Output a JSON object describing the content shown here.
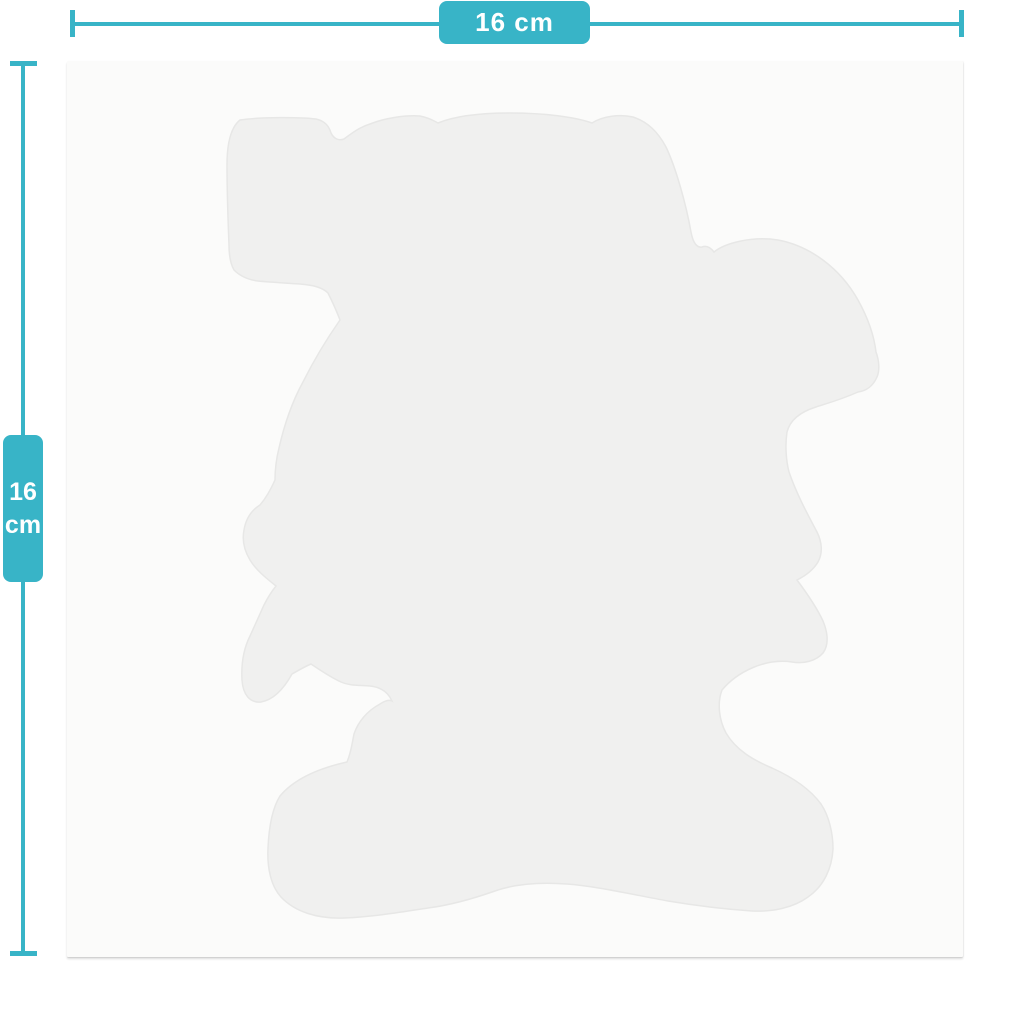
{
  "colors": {
    "accent": "#38b4c7",
    "background": "#ffffff",
    "sheet": "#fbfbfa",
    "silhouette": "#f0f0ef",
    "silhouette_edge": "#e7e7e6",
    "label_text": "#ffffff"
  },
  "width_dimension": {
    "label": "16 cm"
  },
  "height_dimension": {
    "value": "16",
    "unit": "cm"
  }
}
